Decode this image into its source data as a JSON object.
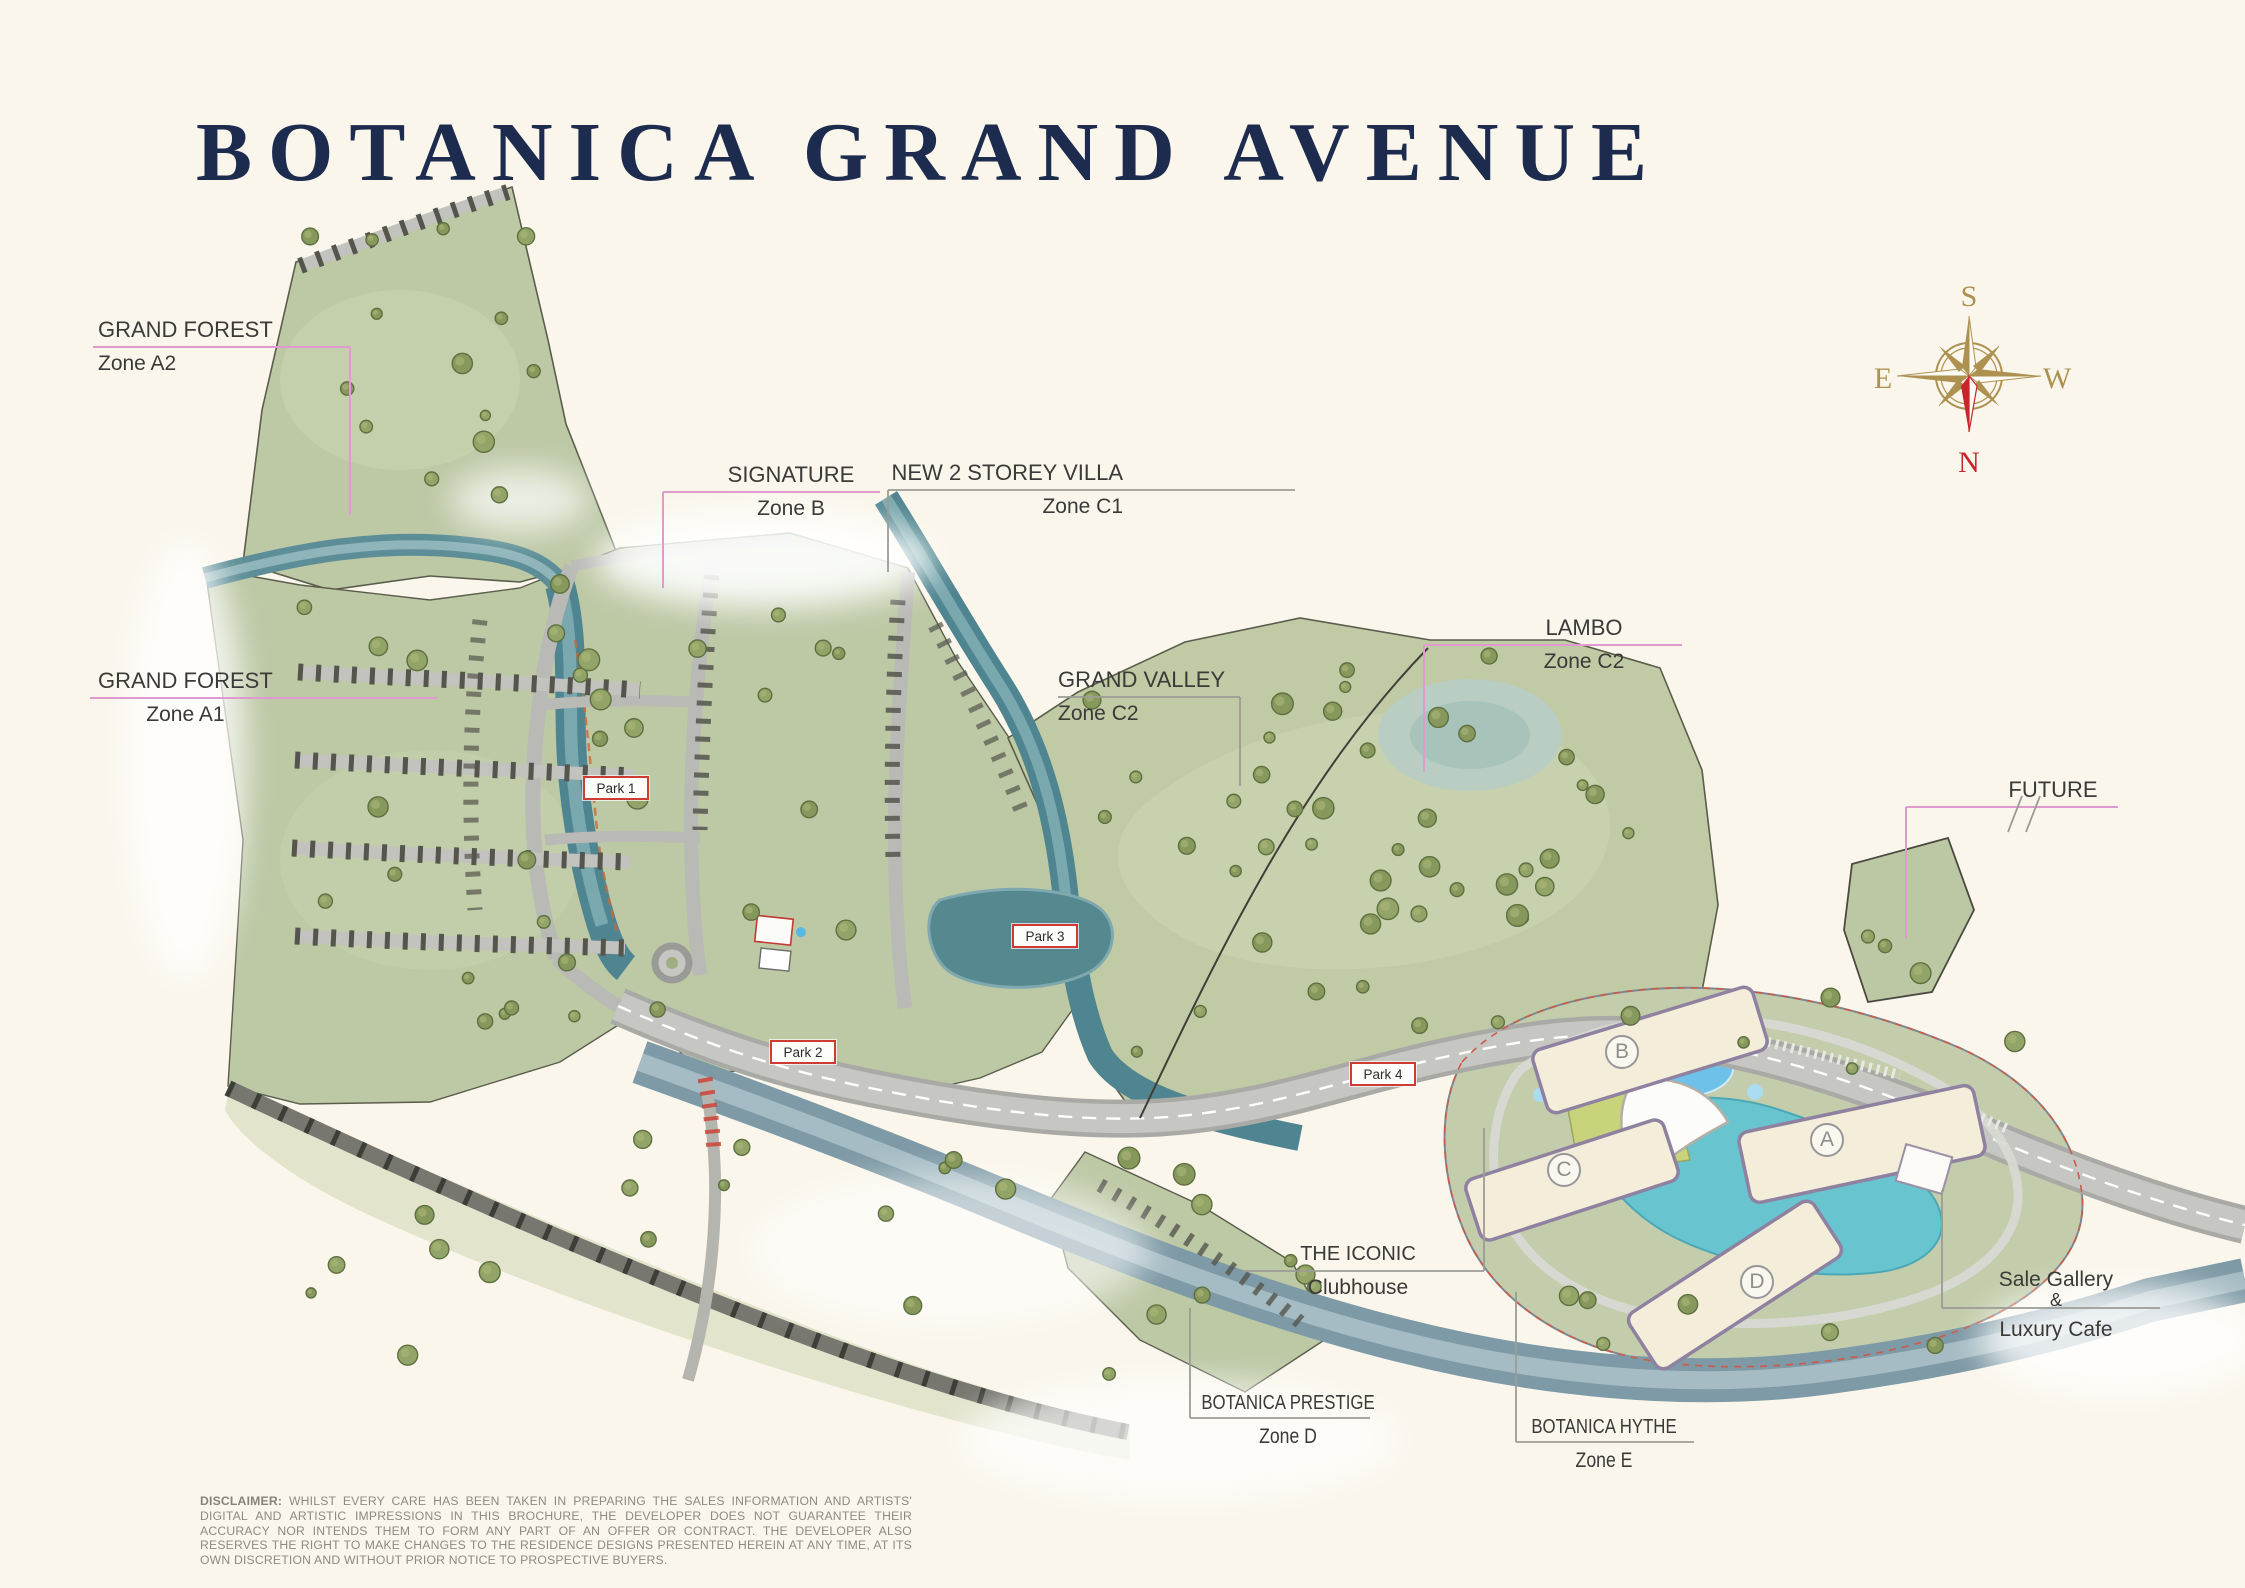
{
  "title": "BOTANICA GRAND AVENUE",
  "compass": {
    "south": "S",
    "east": "E",
    "west": "W",
    "north": "N"
  },
  "zone_labels": {
    "grand_forest_a2": {
      "name": "GRAND FOREST",
      "zone": "Zone A2"
    },
    "signature_b": {
      "name": "SIGNATURE",
      "zone": "Zone B"
    },
    "new_2_storey_villa_c1": {
      "name": "NEW 2 STOREY VILLA",
      "zone": "Zone C1"
    },
    "grand_forest_a1": {
      "name": "GRAND FOREST",
      "zone": "Zone A1"
    },
    "grand_valley_c2": {
      "name": "GRAND VALLEY",
      "zone": "Zone C2"
    },
    "lambo_c2": {
      "name": "LAMBO",
      "zone": "Zone C2"
    },
    "future": {
      "name": "FUTURE"
    },
    "the_iconic": {
      "name": "THE ICONIC",
      "zone": "Clubhouse"
    },
    "sale_gallery": {
      "line1": "Sale Gallery",
      "line2": "&",
      "line3": "Luxury Cafe"
    },
    "botanica_prestige_d": {
      "name": "BOTANICA PRESTIGE",
      "zone": "Zone D"
    },
    "botanica_hythe_e": {
      "name": "BOTANICA HYTHE",
      "zone": "Zone E"
    }
  },
  "park_labels": {
    "park1": "Park 1",
    "park2": "Park 2",
    "park3": "Park 3",
    "park4": "Park 4"
  },
  "building_letters": {
    "a": "A",
    "b": "B",
    "c": "C",
    "d": "D"
  },
  "disclaimer": {
    "label": "DISCLAIMER:",
    "line1": "WHILST EVERY CARE HAS BEEN TAKEN IN PREPARING THE SALES INFORMATION AND ARTISTS' DIGITAL AND ARTISTIC IMPRESSIONS IN THIS BROCHURE, THE DEVELOPER",
    "line2": "DOES NOT GUARANTEE THEIR ACCURACY NOR INTENDS THEM TO FORM ANY PART OF AN OFFER OR CONTRACT. THE DEVELOPER ALSO RESERVES THE RIGHT TO MAKE CHANGES",
    "line3": "TO THE RESIDENCE DESIGNS PRESENTED HEREIN AT ANY TIME, AT ITS OWN DISCRETION AND WITHOUT PRIOR NOTICE TO PROSPECTIVE BUYERS."
  },
  "colors": {
    "background": "#faf6eb",
    "title": "#1d2c4e",
    "label_text": "#3a3a38",
    "leader_pink": "#df9bd0",
    "leader_gray": "#9c9c96",
    "compass_gold": "#ad9150",
    "compass_red": "#c8262c",
    "park_border": "#cf3a32"
  }
}
